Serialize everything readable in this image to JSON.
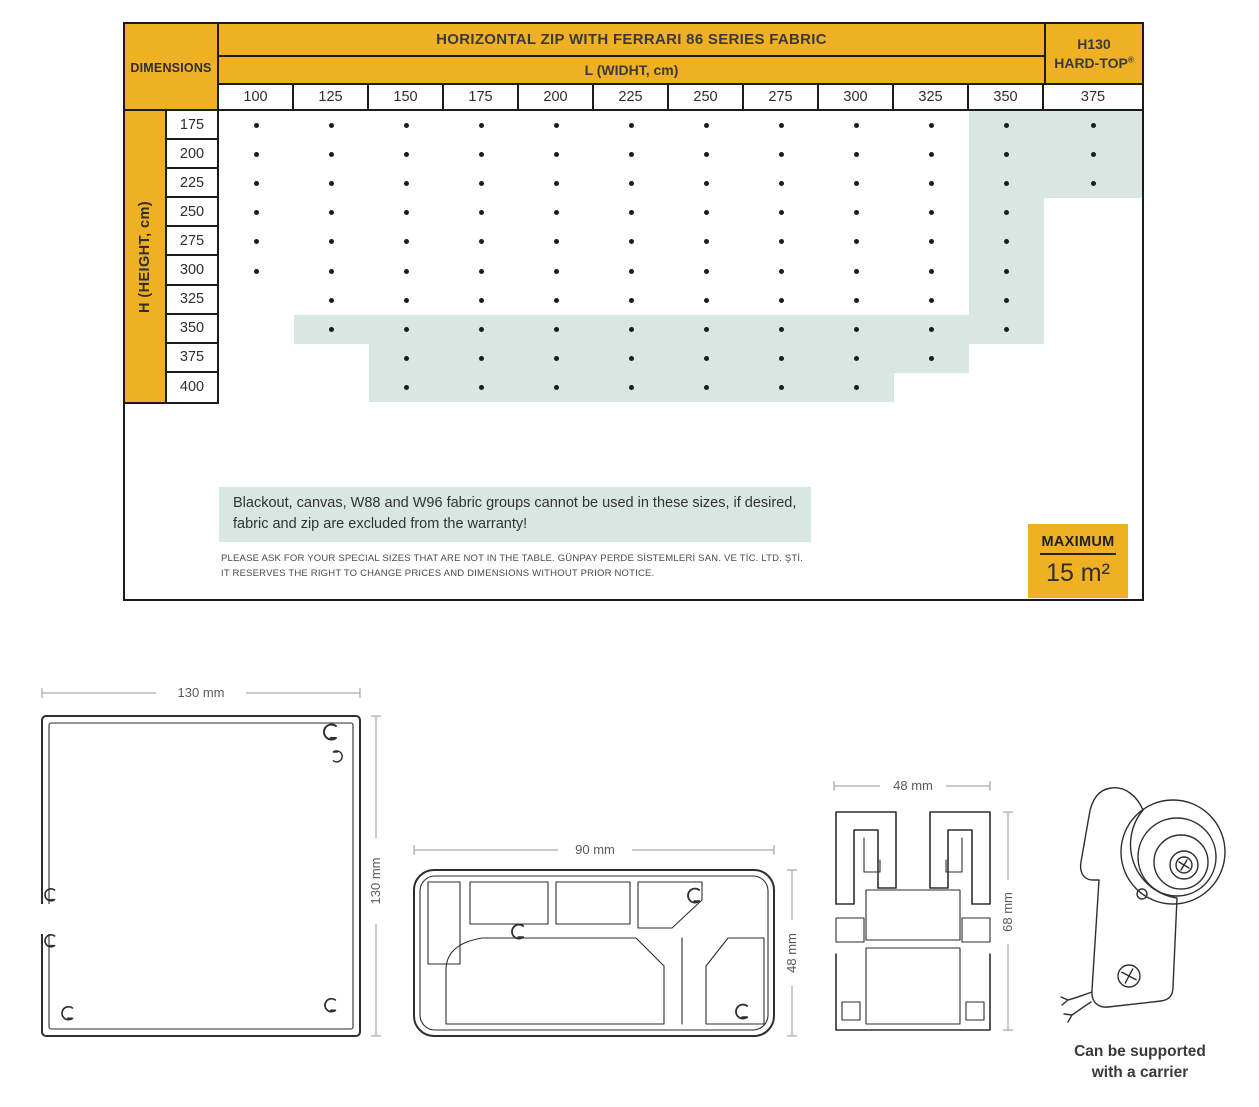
{
  "colors": {
    "gold": "#F0B023",
    "teal": "#D8E7E2",
    "border": "#1b1b1b",
    "text": "#383838"
  },
  "table": {
    "corner_label": "DIMENSIONS",
    "title": "HORIZONTAL ZIP WITH FERRARI 86 SERIES FABRIC",
    "subtitle": "L (WIDHT, cm)",
    "right_header": {
      "line1": "H130",
      "line2": "HARD-TOP",
      "reg": "®"
    },
    "row_axis_label": "H (HEIGHT, cm)",
    "columns": [
      "100",
      "125",
      "150",
      "175",
      "200",
      "225",
      "250",
      "275",
      "300",
      "325",
      "350",
      "375"
    ],
    "rows": [
      "175",
      "200",
      "225",
      "250",
      "275",
      "300",
      "325",
      "350",
      "375",
      "400"
    ],
    "availability": [
      [
        1,
        1,
        1,
        1,
        1,
        1,
        1,
        1,
        1,
        1,
        1,
        1
      ],
      [
        1,
        1,
        1,
        1,
        1,
        1,
        1,
        1,
        1,
        1,
        1,
        1
      ],
      [
        1,
        1,
        1,
        1,
        1,
        1,
        1,
        1,
        1,
        1,
        1,
        1
      ],
      [
        1,
        1,
        1,
        1,
        1,
        1,
        1,
        1,
        1,
        1,
        1,
        0
      ],
      [
        1,
        1,
        1,
        1,
        1,
        1,
        1,
        1,
        1,
        1,
        1,
        0
      ],
      [
        1,
        1,
        1,
        1,
        1,
        1,
        1,
        1,
        1,
        1,
        1,
        0
      ],
      [
        0,
        1,
        1,
        1,
        1,
        1,
        1,
        1,
        1,
        1,
        1,
        0
      ],
      [
        0,
        1,
        1,
        1,
        1,
        1,
        1,
        1,
        1,
        1,
        1,
        0
      ],
      [
        0,
        0,
        1,
        1,
        1,
        1,
        1,
        1,
        1,
        1,
        0,
        0
      ],
      [
        0,
        0,
        1,
        1,
        1,
        1,
        1,
        1,
        1,
        0,
        0,
        0
      ]
    ],
    "highlighted": [
      [
        0,
        0,
        0,
        0,
        0,
        0,
        0,
        0,
        0,
        0,
        1,
        1
      ],
      [
        0,
        0,
        0,
        0,
        0,
        0,
        0,
        0,
        0,
        0,
        1,
        1
      ],
      [
        0,
        0,
        0,
        0,
        0,
        0,
        0,
        0,
        0,
        0,
        1,
        1
      ],
      [
        0,
        0,
        0,
        0,
        0,
        0,
        0,
        0,
        0,
        0,
        1,
        0
      ],
      [
        0,
        0,
        0,
        0,
        0,
        0,
        0,
        0,
        0,
        0,
        1,
        0
      ],
      [
        0,
        0,
        0,
        0,
        0,
        0,
        0,
        0,
        0,
        0,
        1,
        0
      ],
      [
        0,
        0,
        0,
        0,
        0,
        0,
        0,
        0,
        0,
        0,
        1,
        0
      ],
      [
        0,
        1,
        1,
        1,
        1,
        1,
        1,
        1,
        1,
        1,
        1,
        0
      ],
      [
        0,
        0,
        1,
        1,
        1,
        1,
        1,
        1,
        1,
        1,
        0,
        0
      ],
      [
        0,
        0,
        1,
        1,
        1,
        1,
        1,
        1,
        1,
        0,
        0,
        0
      ]
    ]
  },
  "notes": {
    "warning_line1": "Blackout, canvas, W88 and W96 fabric groups cannot be used in these sizes, if desired,",
    "warning_line2": "fabric and zip are excluded from the warranty!",
    "fine_print_line1": "PLEASE ASK FOR YOUR SPECIAL SIZES THAT ARE NOT IN THE TABLE. GÜNPAY PERDE SİSTEMLERİ SAN. VE TİC. LTD. ŞTİ.",
    "fine_print_line2": "IT RESERVES THE RIGHT TO CHANGE PRICES AND DIMENSIONS WITHOUT PRIOR NOTICE."
  },
  "badge": {
    "label": "MAXIMUM",
    "value": "15 m²"
  },
  "drawings": {
    "profile_square": {
      "width_label": "130 mm",
      "height_label": "130 mm"
    },
    "profile_bottom": {
      "width_label": "90 mm",
      "height_label": "48 mm"
    },
    "profile_track": {
      "width_label": "48 mm",
      "height_label": "68 mm"
    },
    "motor": {
      "caption_line1": "Can be supported",
      "caption_line2": "with a carrier"
    }
  }
}
